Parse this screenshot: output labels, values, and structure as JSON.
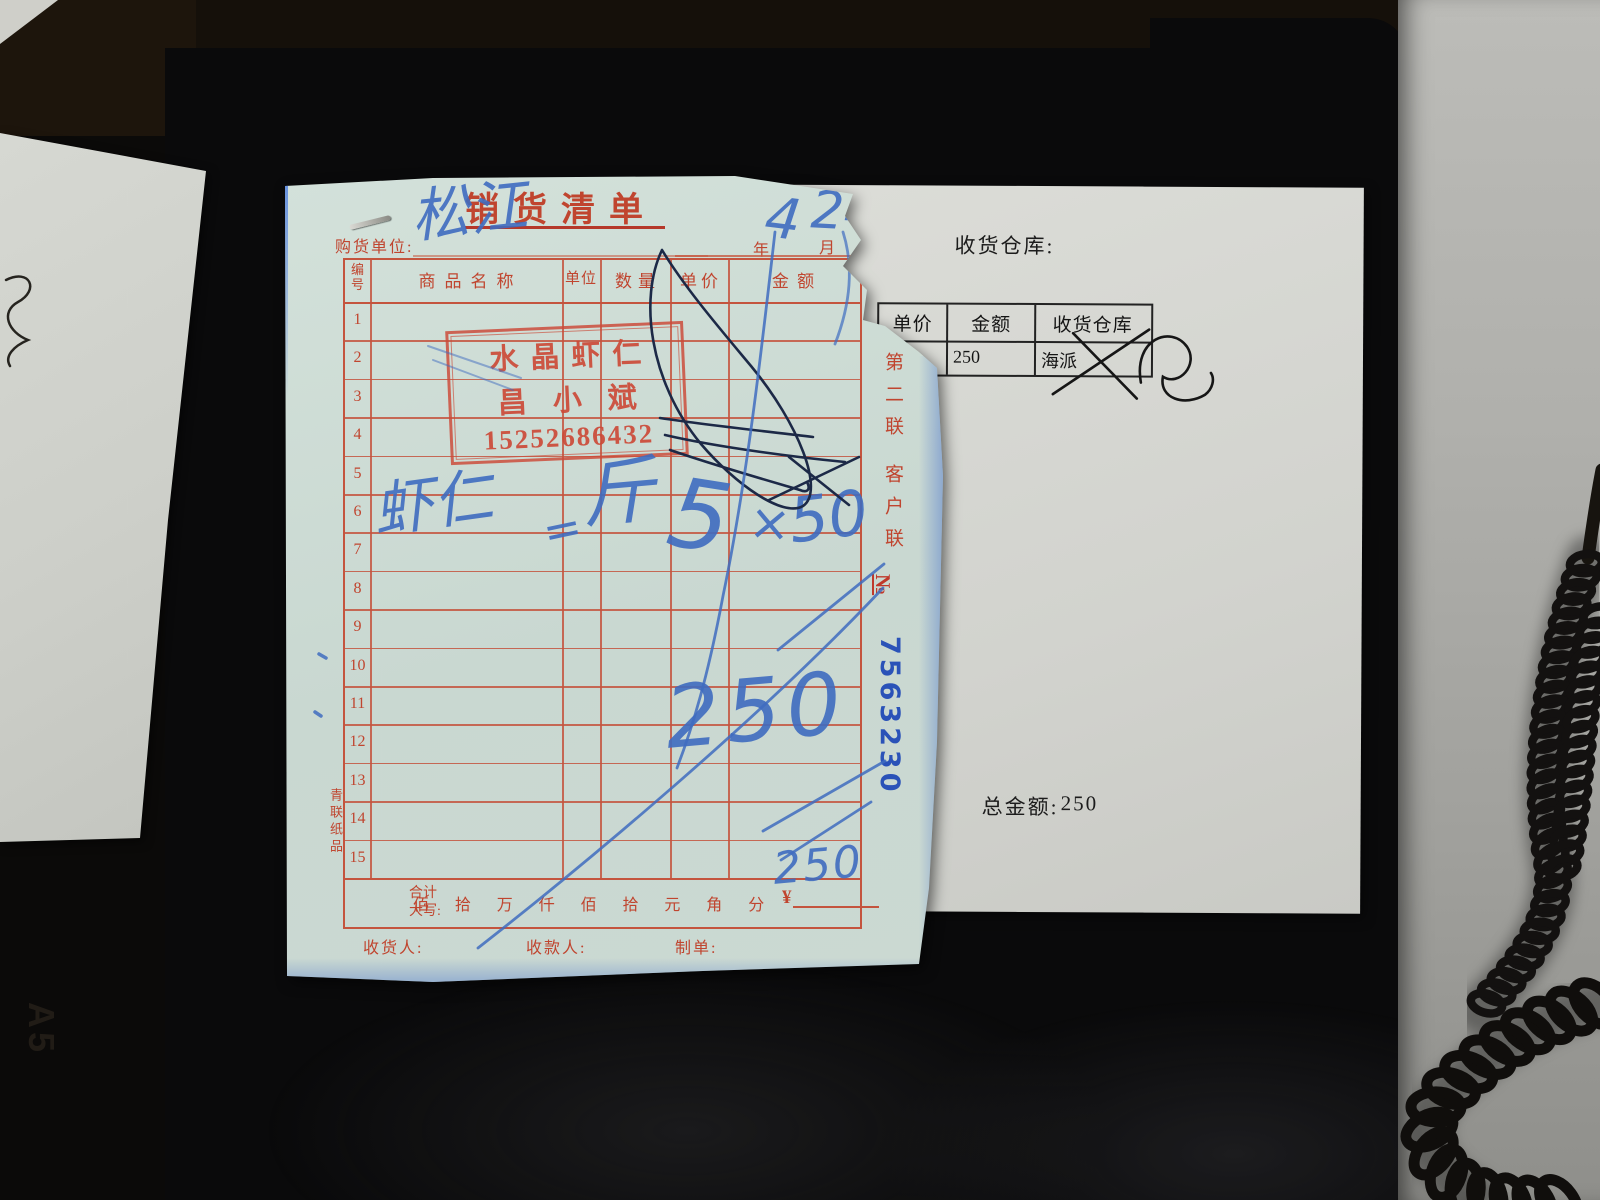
{
  "scene": {
    "desk_marking": "A5"
  },
  "receipt": {
    "title": "销货清单",
    "purchaser_label": "购货单位:",
    "date": {
      "year_label": "年",
      "month_label": "月"
    },
    "table": {
      "col_headers": [
        "编号",
        "商品名称",
        "单位",
        "数量",
        "单价",
        "金 额"
      ],
      "row_numbers": [
        "1",
        "2",
        "3",
        "4",
        "5",
        "6",
        "7",
        "8",
        "9",
        "10",
        "11",
        "12",
        "13",
        "14",
        "15"
      ]
    },
    "stamp": {
      "line1": "水晶虾仁",
      "line2": "昌小斌",
      "phone": "15252686432"
    },
    "side": {
      "copy_line1": "第二联",
      "copy_line2": "客户联",
      "serial_label": "№",
      "serial_number": "7563230",
      "brand": "青联纸品"
    },
    "total_row": {
      "label_line1": "合计",
      "label_line2": "大写:",
      "units": [
        "佰",
        "拾",
        "万",
        "仟",
        "佰",
        "拾",
        "元",
        "角",
        "分"
      ],
      "currency": "¥"
    },
    "footer": {
      "receiver_label": "收货人:",
      "payee_label": "收款人:",
      "preparer_label": "制单:"
    },
    "handwriting": {
      "purchaser": "松江",
      "month": "4",
      "day": "24",
      "item": "虾仁",
      "equals": "=",
      "unit": "斤",
      "qty": "5",
      "times": "×",
      "price": "50",
      "amount": "250",
      "total": "250"
    }
  },
  "delivery_note": {
    "warehouse_label": "收货仓库:",
    "table": {
      "headers": [
        "单价",
        "金额",
        "收货仓库"
      ],
      "row": {
        "unit_price": "",
        "amount": "250",
        "warehouse": "海派"
      }
    },
    "total_label": "总金额:",
    "total_value": "250"
  },
  "colors": {
    "grid_red": "#c4543e",
    "stamp_red": "#cc4a38",
    "pen_blue": "#3f6cc0",
    "pen_dark": "#1c2947",
    "serial_blue": "#2a52b8",
    "receipt_paper": "#ccdcd6",
    "note_paper": "#d6d7d2",
    "desk_gray": "#aaaaa6",
    "background": "#0b0a09"
  }
}
